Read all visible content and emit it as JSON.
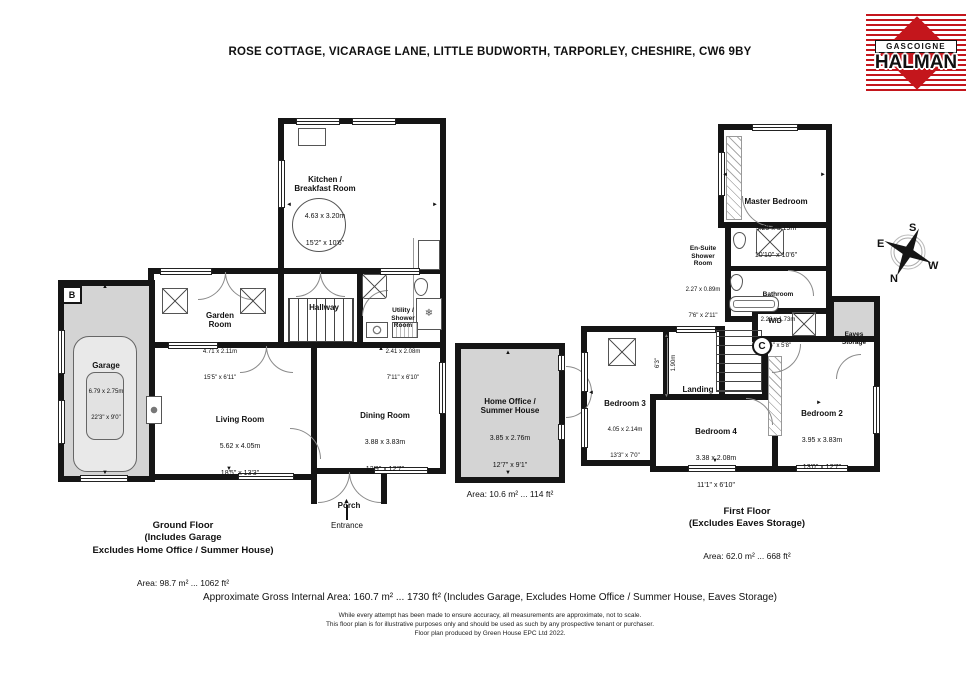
{
  "page": {
    "title": "ROSE COTTAGE, VICARAGE LANE, LITTLE BUDWORTH, TARPORLEY, CHESHIRE, CW6 9BY"
  },
  "logo": {
    "top": "GASCOIGNE",
    "bottom": "HALMAN"
  },
  "icons": {
    "tri_up": "▲",
    "tri_down": "▼",
    "tri_left": "◄",
    "tri_right": "►",
    "snowflake": "❄"
  },
  "compass": {
    "n": "N",
    "s": "S",
    "e": "E",
    "w": "W"
  },
  "ground_floor": {
    "rooms": {
      "kitchen": {
        "name": "Kitchen /\nBreakfast Room",
        "metric": "4.63 x 3.20m",
        "imperial": "15'2\" x 10'6\""
      },
      "garden": {
        "name": "Garden\nRoom",
        "metric": "4.71 x 2.11m",
        "imperial": "15'5\" x 6'11\""
      },
      "hallway": {
        "name": "Hallway"
      },
      "utility": {
        "name": "Utility /\nShower\nRoom",
        "metric": "2.41 x 2.08m",
        "imperial": "7'11\" x 6'10\""
      },
      "garage": {
        "name": "Garage",
        "metric": "6.79 x 2.75m",
        "imperial": "22'3\" x 9'0\""
      },
      "living": {
        "name": "Living Room",
        "metric": "5.62 x 4.05m",
        "imperial": "18'5\" x 13'3\""
      },
      "dining": {
        "name": "Dining Room",
        "metric": "3.88 x 3.83m",
        "imperial": "12'9\" x 12'7\""
      },
      "porch": {
        "name": "Porch"
      }
    },
    "entrance_label": "Entrance",
    "boiler_label": "B",
    "caption": {
      "bold": "Ground Floor\n(Includes Garage\nExcludes Home Office / Summer House)",
      "area": "Area: 98.7 m² ... 1062 ft²"
    }
  },
  "outbuilding": {
    "room": {
      "name": "Home Office /\nSummer House",
      "metric": "3.85 x 2.76m",
      "imperial": "12'7\" x 9'1\""
    },
    "caption_area": "Area: 10.6 m² ... 114 ft²"
  },
  "first_floor": {
    "rooms": {
      "master": {
        "name": "Master Bedroom",
        "metric": "3.29 x 3.19m",
        "imperial": "10'10\" x 10'6\""
      },
      "ensuite": {
        "name": "En-Suite\nShower\nRoom",
        "metric": "2.27 x 0.89m",
        "imperial": "7'6\" x 2'11\""
      },
      "bathroom": {
        "name": "Bathroom",
        "metric": "2.28 x 1.73m",
        "imperial": "7'6\" x 5'8\""
      },
      "bed2": {
        "name": "Bedroom 2",
        "metric": "3.95 x 3.83m",
        "imperial": "13'0\" x 12'7\""
      },
      "bed3": {
        "name": "Bedroom 3",
        "metric": "4.05 x 2.14m",
        "imperial": "13'3\" x 7'0\""
      },
      "bed4": {
        "name": "Bedroom 4",
        "metric": "3.38 x 2.08m",
        "imperial": "11'1\" x 6'10\""
      },
      "landing": {
        "name": "Landing",
        "dim_metric": "1.90m",
        "dim_imperial": "6'3\""
      },
      "eaves": {
        "name": "Eaves\nStorage"
      }
    },
    "wd_label": "W/D",
    "cylinder_label": "C",
    "caption": {
      "bold": "First Floor\n(Excludes Eaves Storage)",
      "area": "Area: 62.0 m² ... 668 ft²"
    }
  },
  "footer": {
    "gross_area": "Approximate Gross Internal Area: 160.7 m² ... 1730 ft² (Includes Garage, Excludes Home Office / Summer House, Eaves Storage)",
    "disclaimer1": "While every attempt has been made to ensure accuracy, all measurements are approximate, not to scale.",
    "disclaimer2": "This floor plan is for illustrative purposes only and should be used as such by any prospective tenant or purchaser.",
    "disclaimer3": "Floor plan produced by Green House EPC Ltd 2022."
  },
  "colors": {
    "wall": "#151515",
    "shaded": "#d4d4d4",
    "brand_red": "#c4161c"
  }
}
